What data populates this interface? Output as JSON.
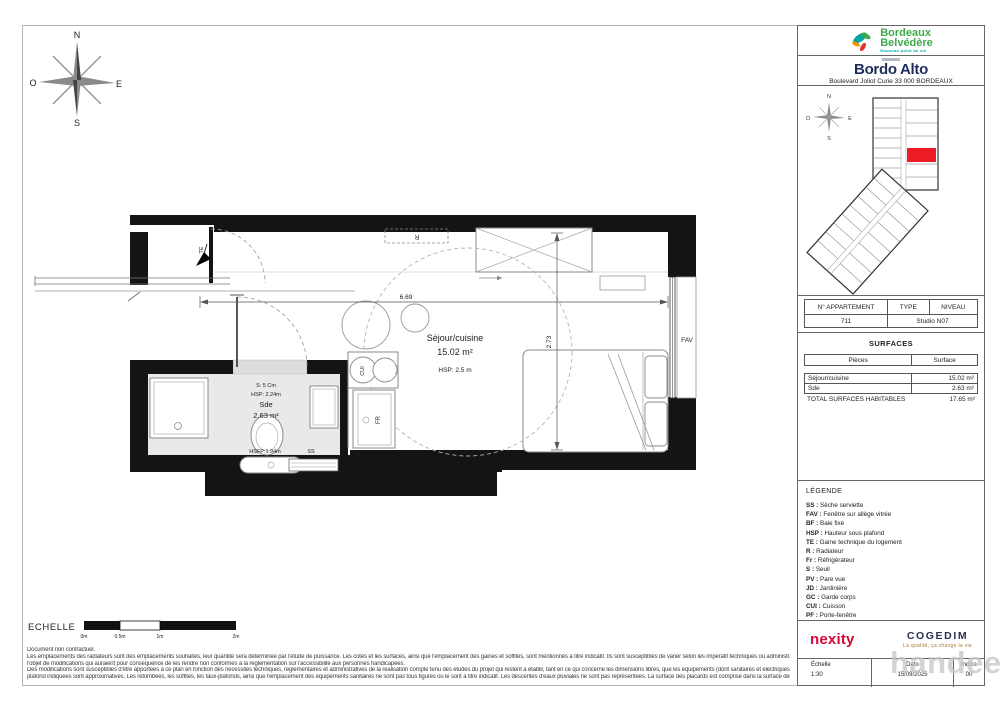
{
  "page": {
    "watermark": "handee"
  },
  "compass": {
    "n": "N",
    "s": "S",
    "e": "E",
    "o": "O"
  },
  "plan": {
    "dims": {
      "width": "6.69",
      "height": "2.73"
    },
    "sejour": {
      "name": "Séjour/cuisine",
      "area": "15.02 m²",
      "hsp": "HSP: 2.5 m"
    },
    "sde": {
      "seuil": "S: 5 Cm",
      "hsp": "HSP: 2.24m",
      "name": "Sde",
      "area": "2.63 m²",
      "hsfp": "HSFP:1.94m"
    },
    "labels": {
      "te": "TE",
      "r": "R",
      "fav": "FAV",
      "cui": "CUI",
      "fr": "FR",
      "ss": "SS"
    }
  },
  "scalebar": {
    "label": "ECHELLE",
    "ticks": [
      "0m",
      "0.5m",
      "1m",
      "2m"
    ]
  },
  "disclaimer": [
    "Document non contractuel.",
    "Les emplacements des radiateurs sont des emplacements souhaités, leur quantité sera déterminée par l'étude de puissance. Les cotes et les surfaces, ainsi que l'emplacement des gaines et soffites, sont mentionnés à titre indicatif. Ils sont susceptibles de varier selon les impératif techniques ou administratifs. Les logements ne peuvent faire",
    "l'objet de modifications qui auraient pour conséquence de les rendre non conformes à la réglementation sur l'accessibilité aux personnes handicapées.",
    "Des modifications sont susceptibles d'être apportées à ce plan en fonction des nécessités techniques, réglementaires et administratives de la réalisation compte tenu des études du projet qui restent à établir, tant en ce qui concerne les dimensions libres, que les équipements (dont sanitaires et électriques). Les surfaces et hauteurs sous",
    "plafond indiquées sont approximatives. Les retombées, les soffites, les faux-plafonds, ainsi que l'emplacement des équipements sanitaires ne sont pas tous figurés ou le sont à titre indicatif. Les descentes d'eaux pluviales ne sont pas représentées. La surface des placards est comprise dans la surface des pièces attenantes."
  ],
  "panel": {
    "brand1": {
      "line1": "Bordeaux",
      "line2": "Belvédère",
      "tagline": "Nouveau point de vie"
    },
    "brand2": {
      "name": "Bordo Alto",
      "address": "Boulevard Joliot Curie 33 000 BORDEAUX"
    },
    "apt": {
      "h1": "N° APPARTEMENT",
      "h2": "TYPE",
      "h3": "NIVEAU",
      "number": "711",
      "type_level": "Studio N07"
    },
    "surfaces": {
      "title": "SURFACES",
      "col1": "Pièces",
      "col2": "Surface",
      "rows": [
        {
          "name": "Séjour/cuisine",
          "value": "15.02 m²"
        },
        {
          "name": "Sde",
          "value": "2.63 m²"
        }
      ],
      "total_label": "TOTAL SURFACES HABITABLES",
      "total_value": "17.65 m²"
    },
    "legend": {
      "title": "LÉGENDE",
      "items": [
        {
          "code": "SS",
          "label": "Sèche serviette"
        },
        {
          "code": "FAV",
          "label": "Fenêtre sur allège vitrée"
        },
        {
          "code": "BF",
          "label": "Baie fixe"
        },
        {
          "code": "HSP",
          "label": "Hauteur sous plafond"
        },
        {
          "code": "TE",
          "label": "Gaine technique du logement"
        },
        {
          "code": "R",
          "label": "Radiateur"
        },
        {
          "code": "Fr",
          "label": "Réfrigérateur"
        },
        {
          "code": "S",
          "label": "Seuil"
        },
        {
          "code": "PV",
          "label": "Pare vue"
        },
        {
          "code": "JD",
          "label": "Jardinière"
        },
        {
          "code": "GC",
          "label": "Garde corps"
        },
        {
          "code": "CUI",
          "label": "Cuisson"
        },
        {
          "code": "PF",
          "label": "Porte-fenêtre"
        }
      ],
      "faux": "Faux plafond"
    },
    "partners": {
      "nexity": "nexity",
      "cogedim": "COGEDIM",
      "cogedim_tagline": "La qualité, ça change la vie"
    },
    "footer": {
      "c1h": "Échelle",
      "c1v": "1:30",
      "c2h": "Date",
      "c2v": "15/09/2025",
      "c3h": "Indice",
      "c3v": "00"
    }
  },
  "colors": {
    "brand_green": "#3faa4b",
    "brand_teal": "#00a3a0",
    "brand_orange": "#f39200",
    "brand_red": "#e6332a",
    "brand_navy": "#1e2c5c",
    "nexity_red": "#d60936",
    "cogedim_navy": "#2a3150",
    "cogedim_gold": "#b0763a",
    "unit_highlight_red": "#ed1c24",
    "wall_black": "#141414",
    "faux_plafond_gray": "#e9e9e9"
  }
}
